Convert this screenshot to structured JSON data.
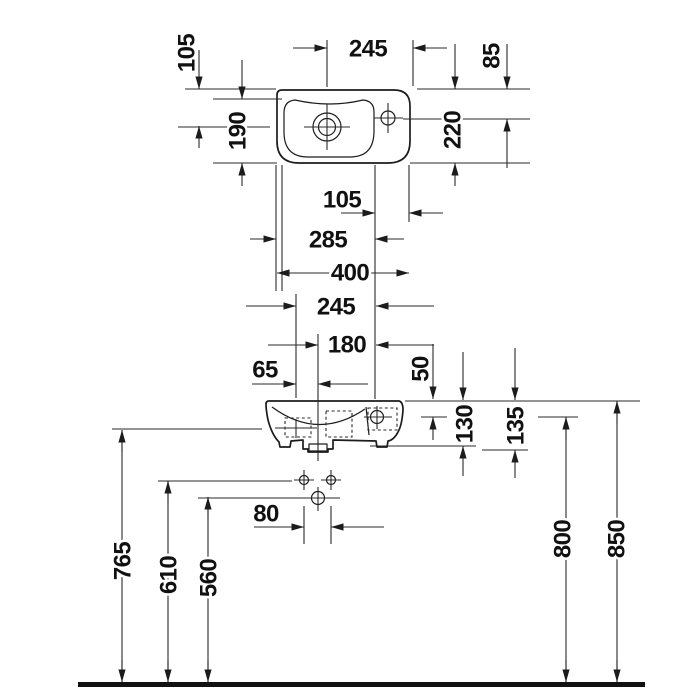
{
  "drawing": {
    "type": "washbasin technical dimension drawing",
    "unit": "mm",
    "dimensions": {
      "drain_to_right_edge": "245",
      "top_to_tap_center": "85",
      "top_to_drain_center": "105",
      "basin_depth": "190",
      "overall_depth": "220",
      "tap_to_right_edge": "105",
      "basin_left_to_tap": "285",
      "overall_width": "400",
      "bracket_to_tap": "245",
      "drain_to_tap": "180",
      "bracket_to_drain": "65",
      "rim_to_tap_front": "50",
      "rim_to_body_bottom": "130",
      "rim_to_outlet_bottom": "135",
      "fixing_hole_spacing": "80",
      "floor_to_bracket": "765",
      "floor_to_fixing_holes": "610",
      "floor_to_drain_pipe": "560",
      "floor_to_tap": "800",
      "floor_to_rim": "850"
    }
  }
}
